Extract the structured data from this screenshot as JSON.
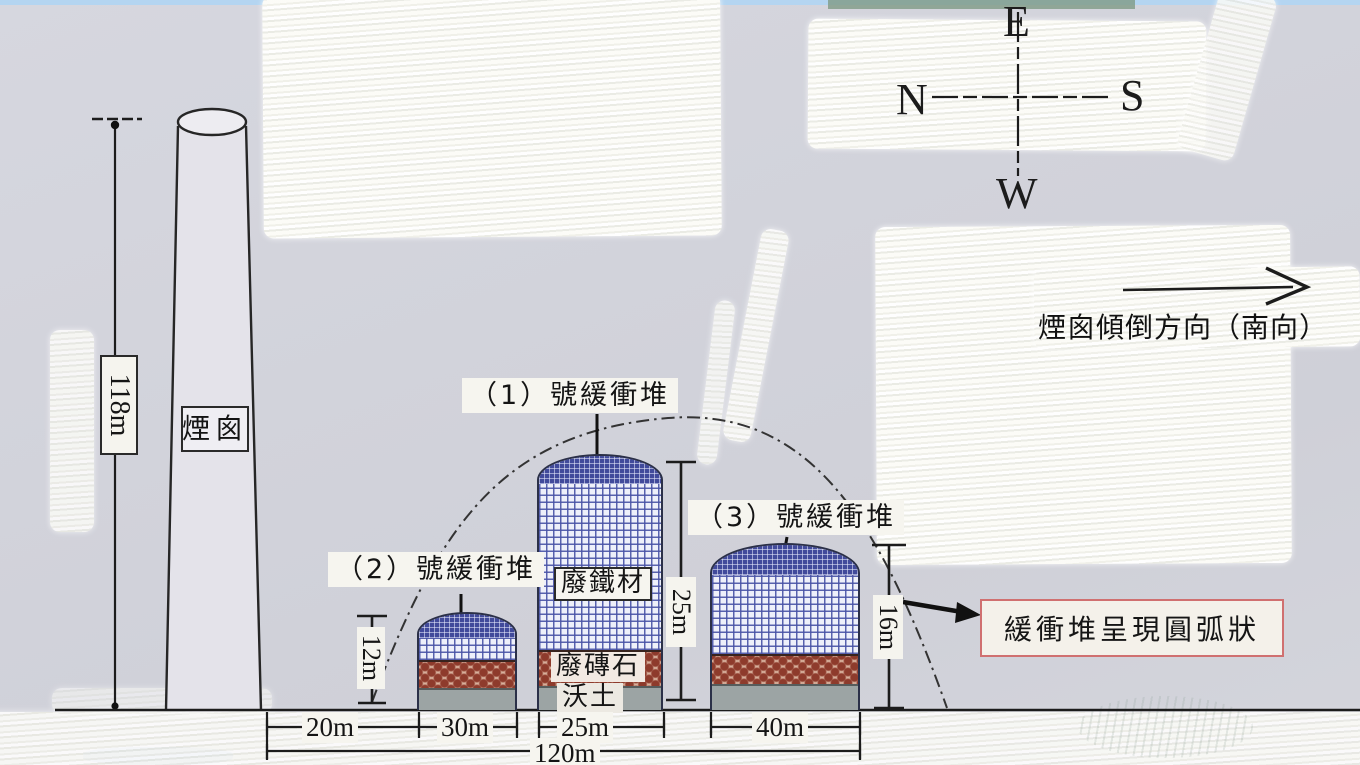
{
  "compass": {
    "top": "E",
    "left": "N",
    "right": "S",
    "bottom": "W"
  },
  "toppling": {
    "text": "煙囪傾倒方向（南向）"
  },
  "chimney": {
    "label": "煙囪",
    "height": "118m"
  },
  "note": {
    "text": "緩衝堆呈現圓弧狀"
  },
  "piles": [
    {
      "label": "（1）號緩衝堆",
      "height": "25m"
    },
    {
      "label": "（2）號緩衝堆",
      "height": "12m"
    },
    {
      "label": "（3）號緩衝堆",
      "height": "16m"
    }
  ],
  "layers": {
    "iron": "廢鐵材",
    "brick": "廢磚石",
    "soil": "沃土"
  },
  "distances": {
    "d1": "20m",
    "d2": "30m",
    "d3": "25m",
    "d4": "40m",
    "total": "120m"
  },
  "colors": {
    "paper": "#d2d3db",
    "paint": "#f6f5ef",
    "grid_dark": "#414a9b",
    "grid_light": "#4852a5",
    "brick": "#8e3b2c",
    "soil": "#9ca4a4",
    "note_border": "#d07070",
    "ink": "#1c1c1c"
  }
}
